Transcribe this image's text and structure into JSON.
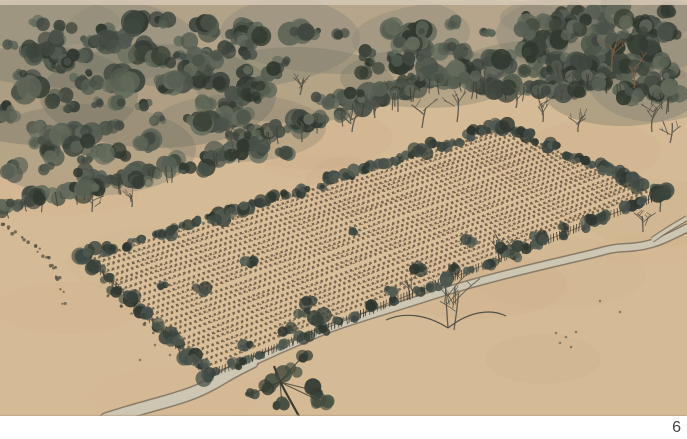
{
  "figure": {
    "page_number": "6",
    "description": "Ink and wash painting: a fenced rectangular field with rows of young crops bordered by bushes, dense woods above, bare trees in a clearing, and a winding stream along the lower edge"
  },
  "painting": {
    "width": 687,
    "height": 416,
    "colors": {
      "paper": "#d5ba96",
      "paper_light": "#dcc29d",
      "mottle": "#c5a87f",
      "top_strip": "#d6c9b6",
      "bottom_edge": "#b5a287",
      "wash": "#8d897a",
      "wash_dark": "#717264",
      "canopy": [
        "#4a5249",
        "#3e463e",
        "#575f53",
        "#30382f",
        "#646b5c"
      ],
      "trunk": "#3c3b31",
      "bare_tree": "#535149",
      "bare_tree_warm": "#7d5f46",
      "mark_dark": "#54483a",
      "mark_warm": "#7a6044",
      "fence": "#322d26",
      "bush": [
        "#46504a",
        "#39433c",
        "#525b50",
        "#2e362f"
      ],
      "stream_fill": "#ccc6b3",
      "stream_edge": "#6b6355",
      "pine": [
        "#3c443c",
        "#333b33",
        "#475042"
      ],
      "speck": "#4b483d",
      "page_number": "#454545"
    },
    "forest": {
      "bands": [
        [
          0,
          250,
          22,
          212,
          152,
          115
        ],
        [
          240,
          425,
          28,
          145,
          90,
          42
        ],
        [
          410,
          565,
          14,
          82,
          96,
          34
        ],
        [
          548,
          687,
          8,
          70,
          108,
          55
        ]
      ],
      "washes": [
        [
          70,
          42,
          128,
          46,
          0.5,
          0
        ],
        [
          210,
          38,
          150,
          52,
          0.48,
          0
        ],
        [
          345,
          32,
          125,
          42,
          0.42,
          0
        ],
        [
          480,
          40,
          128,
          40,
          0.42,
          0
        ],
        [
          608,
          34,
          112,
          44,
          0.5,
          0
        ],
        [
          655,
          78,
          68,
          44,
          0.4,
          0
        ],
        [
          38,
          95,
          100,
          50,
          0.4,
          1
        ],
        [
          158,
          96,
          118,
          52,
          0.38,
          1
        ],
        [
          295,
          85,
          100,
          38,
          0.32,
          1
        ],
        [
          428,
          78,
          88,
          30,
          0.3,
          1
        ],
        [
          545,
          68,
          88,
          28,
          0.32,
          1
        ],
        [
          622,
          92,
          78,
          34,
          0.35,
          1
        ],
        [
          88,
          150,
          108,
          46,
          0.3,
          1
        ],
        [
          238,
          128,
          88,
          34,
          0.24,
          1
        ],
        [
          30,
          22,
          90,
          26,
          0.5,
          0
        ],
        [
          600,
          18,
          100,
          26,
          0.45,
          0
        ],
        [
          668,
          40,
          45,
          40,
          0.3,
          0
        ]
      ],
      "extra_clumps": [
        [
          265,
          150,
          10
        ],
        [
          286,
          156,
          9
        ],
        [
          302,
          122,
          9
        ],
        [
          322,
          100,
          8
        ],
        [
          356,
          96,
          8
        ],
        [
          382,
          86,
          8
        ],
        [
          250,
          142,
          9
        ],
        [
          470,
          78,
          8
        ],
        [
          505,
          84,
          8
        ],
        [
          530,
          70,
          7
        ],
        [
          575,
          92,
          9
        ],
        [
          600,
          82,
          9
        ],
        [
          630,
          95,
          9
        ],
        [
          660,
          60,
          10
        ],
        [
          672,
          90,
          9
        ],
        [
          648,
          28,
          10
        ],
        [
          615,
          45,
          9
        ],
        [
          580,
          30,
          9
        ],
        [
          90,
          190,
          9
        ],
        [
          40,
          200,
          9
        ],
        [
          10,
          205,
          8
        ],
        [
          140,
          182,
          9
        ],
        [
          200,
          168,
          9
        ]
      ]
    },
    "field": {
      "corners": {
        "left": [
          85,
          256
        ],
        "top": [
          503,
          126
        ],
        "right": [
          665,
          193
        ],
        "bottom": [
          208,
          375
        ]
      },
      "row_count": 26
    },
    "field_bushes": [
      [
        250,
        262,
        6
      ],
      [
        312,
        301,
        8
      ],
      [
        356,
        232,
        5
      ],
      [
        420,
        267,
        7
      ],
      [
        470,
        242,
        6
      ],
      [
        522,
        246,
        6
      ],
      [
        562,
        227,
        5
      ],
      [
        602,
        215,
        6
      ],
      [
        640,
        200,
        5
      ],
      [
        200,
        290,
        7
      ],
      [
        162,
        286,
        5
      ],
      [
        302,
        312,
        6
      ],
      [
        392,
        291,
        6
      ],
      [
        452,
        268,
        6
      ],
      [
        540,
        238,
        7
      ],
      [
        590,
        220,
        6
      ],
      [
        505,
        250,
        6
      ],
      [
        320,
        318,
        8
      ],
      [
        285,
        330,
        7
      ],
      [
        245,
        345,
        7
      ]
    ],
    "bare_trees": [
      [
        398,
        112,
        26,
        0
      ],
      [
        422,
        128,
        20,
        0
      ],
      [
        457,
        122,
        24,
        0
      ],
      [
        487,
        97,
        26,
        0
      ],
      [
        516,
        108,
        20,
        0
      ],
      [
        543,
        122,
        18,
        0
      ],
      [
        562,
        97,
        22,
        0
      ],
      [
        578,
        132,
        16,
        0
      ],
      [
        612,
        72,
        28,
        1
      ],
      [
        634,
        88,
        22,
        1
      ],
      [
        652,
        132,
        24,
        0
      ],
      [
        670,
        143,
        20,
        0
      ],
      [
        302,
        142,
        20,
        0
      ],
      [
        352,
        132,
        18,
        0
      ],
      [
        232,
        152,
        20,
        0
      ],
      [
        132,
        207,
        14,
        0
      ],
      [
        92,
        212,
        13,
        0
      ],
      [
        660,
        212,
        18,
        0
      ],
      [
        643,
        232,
        16,
        0
      ],
      [
        410,
        300,
        20,
        0
      ],
      [
        500,
        262,
        22,
        0
      ],
      [
        300,
        95,
        16,
        0
      ],
      [
        375,
        118,
        18,
        0
      ]
    ],
    "sprawl_tree": {
      "x": 448,
      "y": 328,
      "h": 52
    },
    "pine_tree": {
      "trunk": [
        [
          300,
          418
        ],
        [
          290,
          400
        ],
        [
          280,
          382
        ],
        [
          274,
          366
        ]
      ],
      "clumps": [
        [
          268,
          385,
          9
        ],
        [
          292,
          372,
          11
        ],
        [
          312,
          390,
          9
        ],
        [
          282,
          404,
          8
        ],
        [
          322,
          402,
          8
        ],
        [
          252,
          394,
          6
        ],
        [
          302,
          357,
          7
        ]
      ]
    },
    "stream": {
      "main": [
        [
          687,
          228
        ],
        [
          664,
          240
        ],
        [
          640,
          247
        ],
        [
          614,
          248
        ],
        [
          596,
          253
        ],
        [
          566,
          260
        ],
        [
          532,
          268
        ],
        [
          500,
          276
        ],
        [
          470,
          284
        ],
        [
          443,
          292
        ],
        [
          415,
          301
        ],
        [
          386,
          310
        ],
        [
          357,
          319
        ],
        [
          330,
          328
        ],
        [
          306,
          338
        ],
        [
          278,
          350
        ],
        [
          252,
          362
        ],
        [
          232,
          372
        ],
        [
          214,
          383
        ],
        [
          196,
          392
        ],
        [
          172,
          400
        ],
        [
          146,
          407
        ],
        [
          122,
          414
        ],
        [
          106,
          419
        ]
      ],
      "branch": [
        [
          687,
          218
        ],
        [
          670,
          228
        ],
        [
          652,
          240
        ]
      ],
      "width_upper": 6.5,
      "width_lower": 11
    },
    "trails": [
      [
        [
          2,
          226
        ],
        [
          14,
          233
        ],
        [
          26,
          241
        ],
        [
          38,
          250
        ],
        [
          47,
          259
        ],
        [
          54,
          268
        ],
        [
          59,
          278
        ],
        [
          62,
          290
        ],
        [
          64,
          302
        ]
      ],
      [
        [
          10,
          229
        ],
        [
          22,
          237
        ],
        [
          34,
          246
        ],
        [
          44,
          256
        ],
        [
          52,
          266
        ],
        [
          57,
          277
        ]
      ],
      [
        [
          108,
          296
        ],
        [
          120,
          305
        ],
        [
          132,
          314
        ],
        [
          143,
          323
        ],
        [
          154,
          331
        ]
      ]
    ],
    "specks": [
      [
        556,
        333
      ],
      [
        566,
        337
      ],
      [
        576,
        332
      ],
      [
        560,
        343
      ],
      [
        571,
        347
      ],
      [
        600,
        301
      ],
      [
        620,
        312
      ],
      [
        155,
        345
      ],
      [
        170,
        355
      ],
      [
        140,
        360
      ]
    ]
  }
}
